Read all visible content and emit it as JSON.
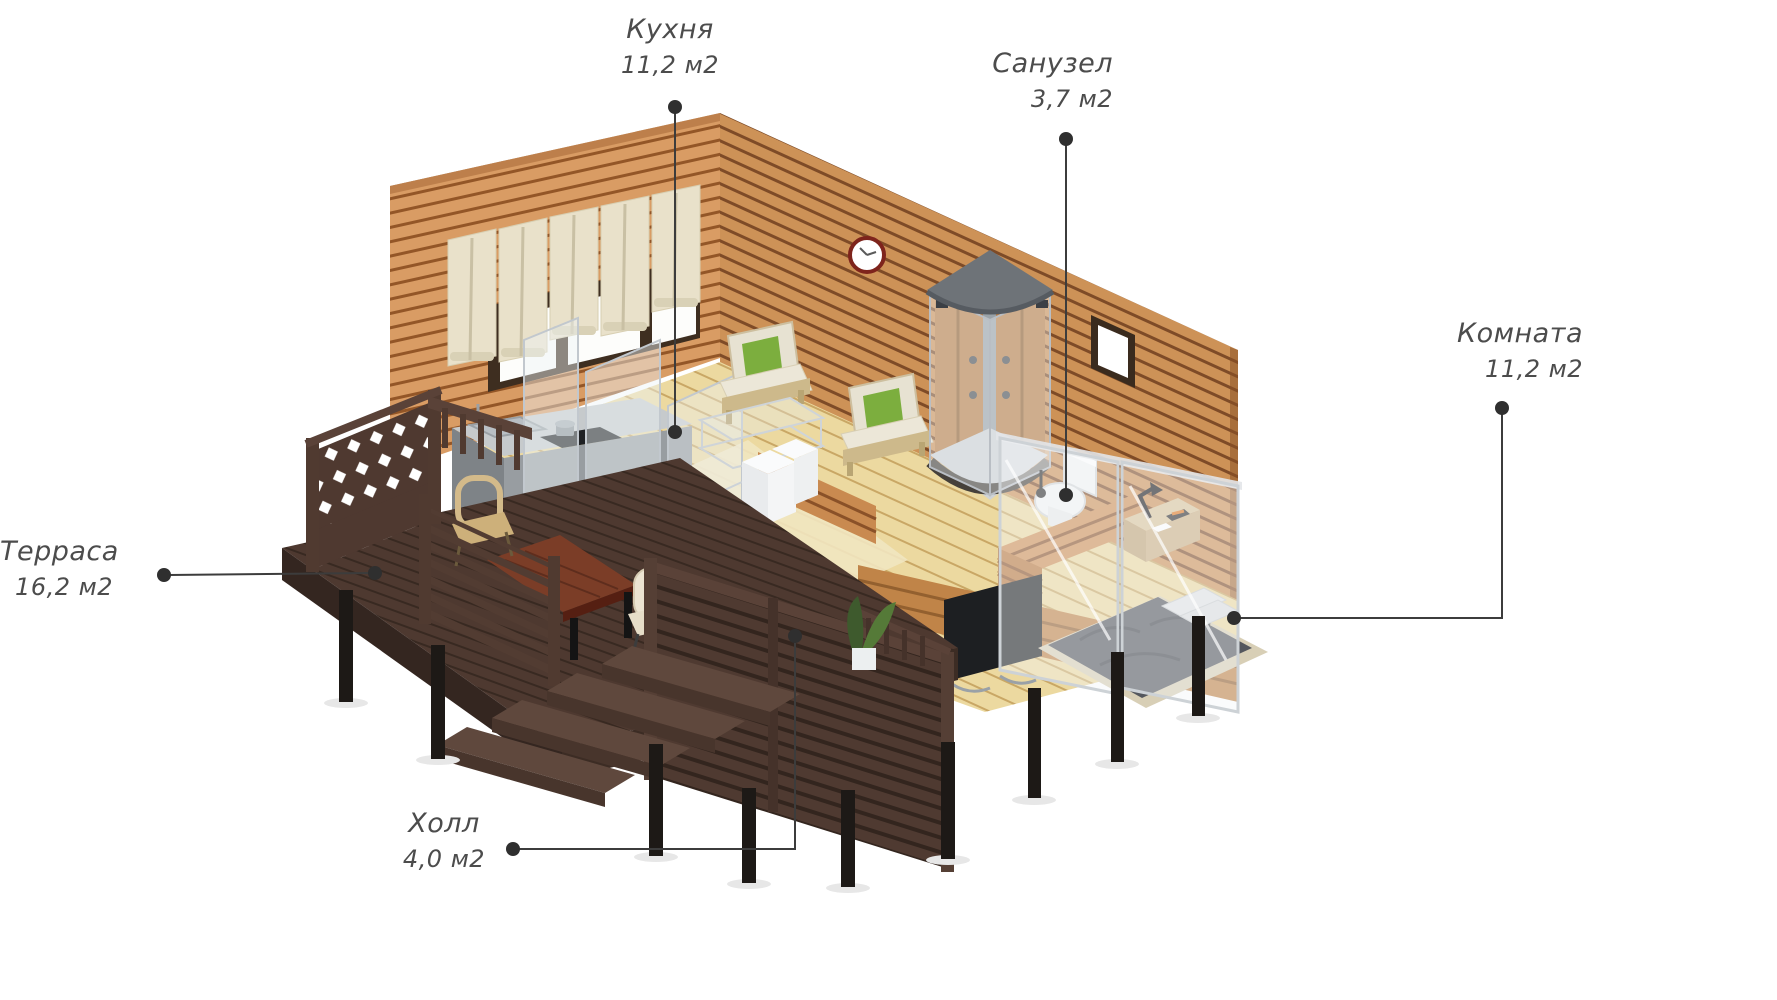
{
  "title": "Изометрический план дома",
  "rooms": [
    {
      "id": "kitchen",
      "name": "Кухня",
      "area": "11,2 м2"
    },
    {
      "id": "bathroom",
      "name": "Санузел",
      "area": "3,7 м2"
    },
    {
      "id": "room",
      "name": "Комната",
      "area": "11,2 м2"
    },
    {
      "id": "terrace",
      "name": "Терраса",
      "area": "16,2 м2"
    },
    {
      "id": "hall",
      "name": "Холл",
      "area": "4,0 м2"
    }
  ],
  "colors": {
    "wall_wood": "#d99c64",
    "wall_groove": "#935627",
    "exterior_wood": "#cd9257",
    "floor_wood": "#ecd9a0",
    "terrace_wood": "#4e3930",
    "post_black": "#1d1916",
    "label_text": "#4c4c4c",
    "leader_line": "#3c3c3c",
    "accent_green": "#7cae3e",
    "counter_gray": "#9ba0a4",
    "glass": "#e9eef2",
    "clock_rim": "#7e241c"
  }
}
